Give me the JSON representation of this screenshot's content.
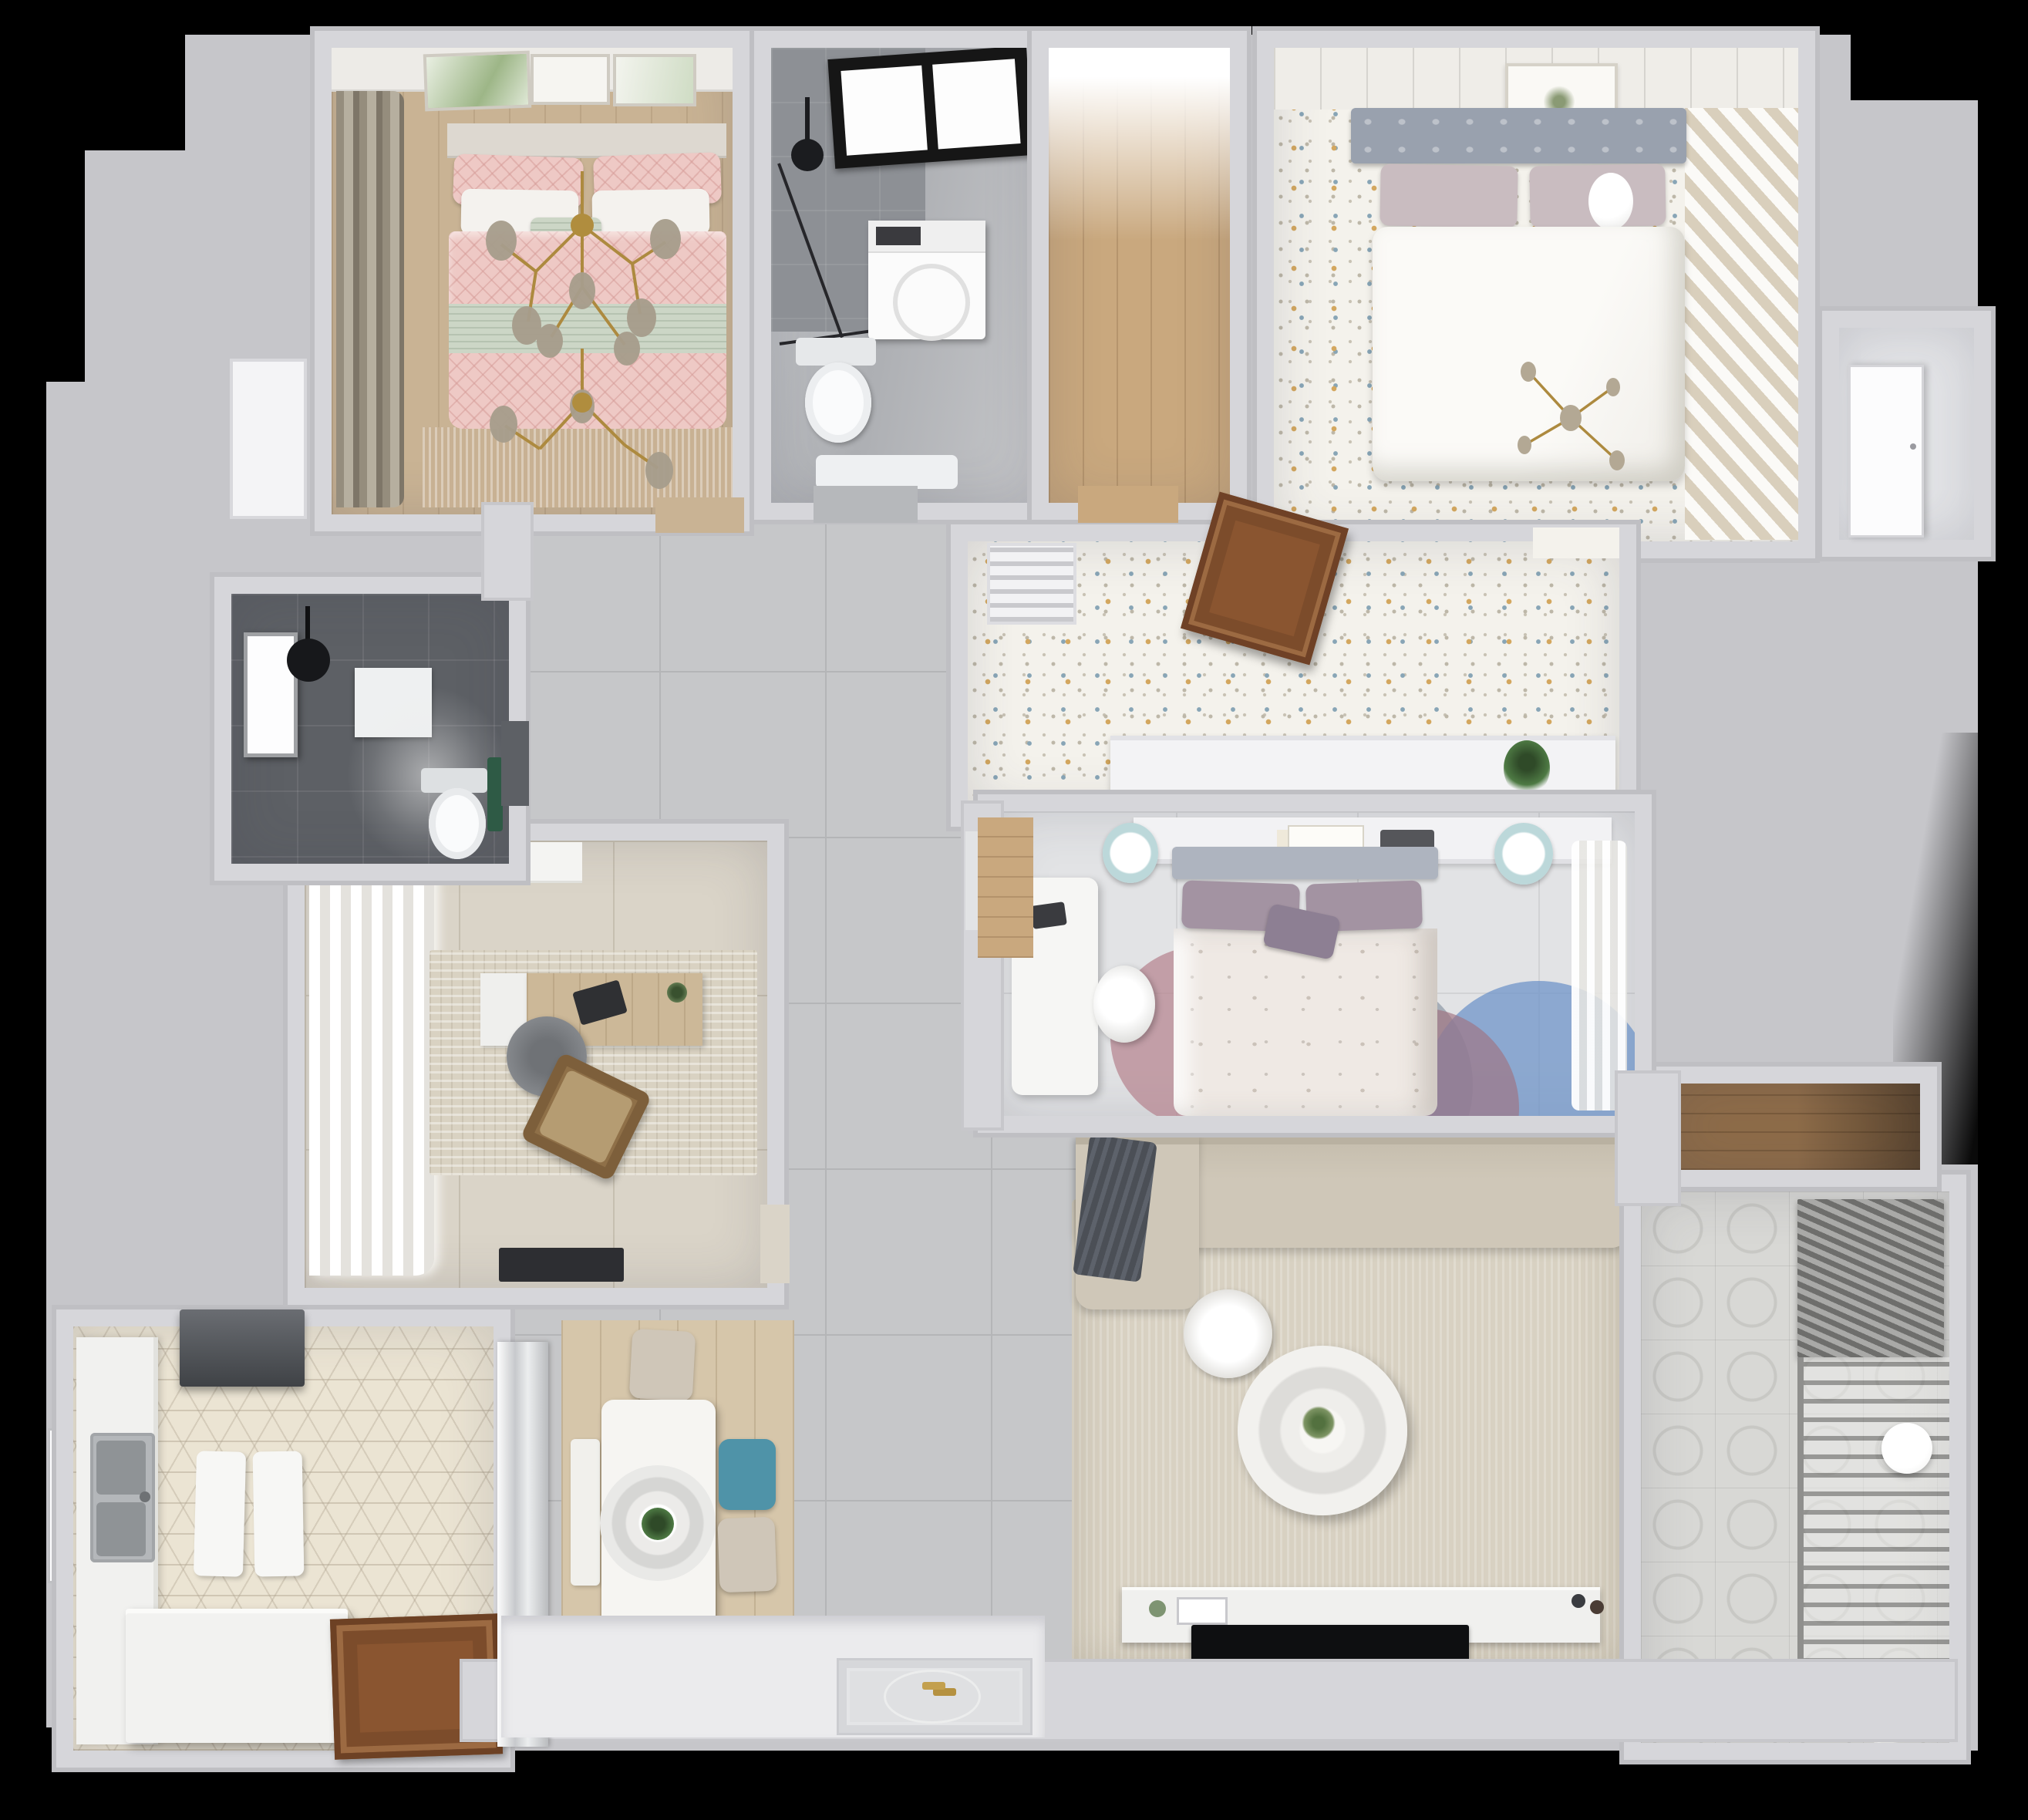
{
  "meta": {
    "type": "3d-apartment-floor-plan-render",
    "view": "top-down",
    "visible_text": "none"
  },
  "palette": {
    "background": "#000000",
    "canvas_outside": "#c6c6ca",
    "wall": "#d6d6da",
    "wall_edge": "#bfbfc3",
    "gray_tile": "#c6c7c9",
    "master_tile": "#e2e3e5",
    "beige_tile": "#dad4c8",
    "gray_marble": "#b6b8bb",
    "dark_tile": "#5d6065",
    "hex_tile": "#ebe4d3",
    "confetti_floor": "#f4f2ec",
    "warm_wood_floor": "#c9b394",
    "closet_wood": "#c9a87e",
    "wood_door": "#8a5530",
    "pink_duvet": "#eec9c5",
    "sage_green": "#ccd6c6",
    "gold_brass": "#ad8a3f",
    "headboard_gray": "#99a1ae",
    "mauve_pillow": "#c9bcc0",
    "purple_cushion": "#8d7f93",
    "teal_chair": "#4f93a8",
    "petal_rug_blue": "#6f94c8",
    "petal_rug_rose": "#b6848f",
    "sofa_beige": "#cfc7b8",
    "throw_dark_gray": "#4b4f56",
    "living_rug": "#d8d1c2",
    "tv_black": "#0e0f11",
    "green_plant": "#4e7a44"
  },
  "rooms": [
    {
      "id": "bedroom-1",
      "name": "Bedroom 1 (pink)",
      "floor": "warm-wood",
      "furniture": [
        "double-bed",
        "pink-patterned-duvet",
        "sage-throw-band",
        "pillows",
        "headboard-wall-frames",
        "side-curtains",
        "brass-branch-chandelier",
        "fringe-rug"
      ]
    },
    {
      "id": "bathroom-1",
      "name": "Bathroom 1 (shower)",
      "floor": "gray-marble",
      "furniture": [
        "dark-shower-zone",
        "black-framed-window",
        "glass-shower-screen",
        "ceiling-shower-head",
        "washing-machine",
        "toilet",
        "bath-mat"
      ]
    },
    {
      "id": "hall-closet",
      "name": "Closet nook",
      "floor": "wood-plank",
      "furniture": []
    },
    {
      "id": "bedroom-2",
      "name": "Bedroom 2 (guest)",
      "floor": "confetti-speckle",
      "furniture": [
        "double-bed",
        "tufted-gray-headboard",
        "white-duvet",
        "mauve-pillows",
        "wall-art-frame",
        "brass-cross-ceiling-light",
        "striped-runner-rug"
      ]
    },
    {
      "id": "closet-2",
      "name": "Closet by bedroom 2",
      "floor": "gray",
      "furniture": [
        "white-door"
      ]
    },
    {
      "id": "north-corridor",
      "name": "North corridor",
      "floor": "confetti-speckle",
      "furniture": [
        "ac-vent-grille",
        "open-wood-door",
        "low-white-console",
        "potted-plant"
      ]
    },
    {
      "id": "master-bedroom",
      "name": "Master bedroom",
      "floor": "light-tile",
      "furniture": [
        "double-bed",
        "purple-pillows",
        "floral-duvet",
        "headboard-shelf-with-books",
        "white-desk",
        "desk-chair",
        "teal-stool-left",
        "teal-stool-right",
        "petal-rug",
        "sheer-curtains"
      ]
    },
    {
      "id": "hallway",
      "name": "Hallway and open living zone",
      "floor": "gray-tile",
      "furniture": []
    },
    {
      "id": "study",
      "name": "Study",
      "floor": "beige-tile",
      "furniture": [
        "storage-cabinet",
        "white-curtains",
        "wood-desk",
        "laptop",
        "office-chair",
        "lounge-chair",
        "distressed-rug",
        "dark-door-mat"
      ]
    },
    {
      "id": "bathroom-2",
      "name": "Bathroom 2 (dark)",
      "floor": "dark-tile",
      "furniture": [
        "window",
        "ceiling-shower",
        "shower-tray",
        "toilet",
        "green-towel"
      ]
    },
    {
      "id": "kitchen",
      "name": "Kitchen",
      "floor": "hex-tile",
      "furniture": [
        "range-hood",
        "side-counter",
        "stainless-double-sink",
        "cutting-boards",
        "island-counter",
        "wood-entry-door",
        "mirror-wardrobe",
        "window"
      ]
    },
    {
      "id": "dining",
      "name": "Dining corner",
      "floor": "wood-area-rug",
      "furniture": [
        "white-table",
        "ring-pendant-lamp",
        "plant-centerpiece",
        "beige-chair-top",
        "teal-chair",
        "beige-chair-bottom",
        "bench"
      ]
    },
    {
      "id": "living-room",
      "name": "Living room",
      "floor": "gray-tile",
      "furniture": [
        "sectional-sofa",
        "chaise",
        "dark-gray-throw",
        "beige-area-rug",
        "round-ring-coffee-table",
        "side-stool",
        "tv-console",
        "flat-tv",
        "decor-items"
      ]
    },
    {
      "id": "balcony",
      "name": "Balcony / laundry",
      "floor": "cement-pattern-tile",
      "furniture": [
        "roller-blind",
        "drying-rack",
        "paper-lantern-ball",
        "toys",
        "small-white-chair",
        "wood-storage-niche"
      ]
    },
    {
      "id": "entry",
      "name": "Entry",
      "floor": "white",
      "furniture": [
        "patterned-door-mat",
        "keys"
      ]
    }
  ]
}
